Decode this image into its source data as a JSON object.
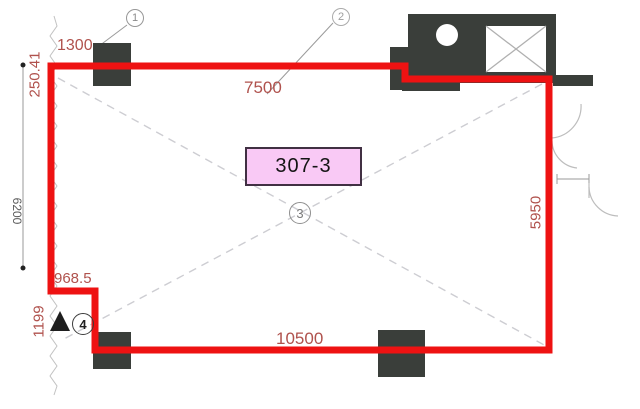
{
  "room": {
    "label": "307-3"
  },
  "dimensions": {
    "top_left_width": "1300",
    "top_left_offset": "250.41",
    "top_width": "7500",
    "left_height": "6200",
    "right_height": "5950",
    "notch_width": "968.5",
    "notch_height": "1199",
    "bottom_width": "10500"
  },
  "grid_bubbles": [
    {
      "number": "1"
    },
    {
      "number": "2"
    },
    {
      "number": "3"
    },
    {
      "number": "4"
    }
  ],
  "colors": {
    "boundary_red": "#ee1212",
    "dimension_red": "#b0524d",
    "column_dark": "#3a3e3a",
    "label_pink_fill": "#f9c9f5",
    "label_border": "#413043",
    "line_gray": "#9a9a9a",
    "dash_gray": "#cdcdd2"
  }
}
